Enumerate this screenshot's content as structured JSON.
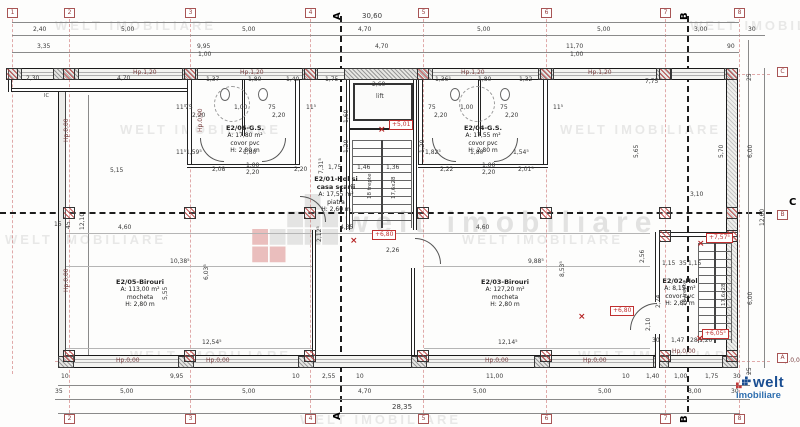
{
  "watermark": {
    "tile_text": "WELT IMOBILIARE",
    "center_text": "welt imobiliare"
  },
  "logo": {
    "brand": "welt",
    "sub": "imobiliare"
  },
  "rooms": {
    "e205": {
      "name": "E2/05-Birouri",
      "area": "A: 113,00 m²",
      "floor": "mocheta",
      "height": "H: 2,80 m"
    },
    "e203": {
      "name": "E2/03-Birouri",
      "area": "A: 127,20 m²",
      "floor": "mocheta",
      "height": "H: 2,80 m"
    },
    "e206": {
      "name": "E2/06-G.S.",
      "area": "A: 17,80 m²",
      "floor": "covor pvc",
      "height": "H: 2,80 m"
    },
    "e204": {
      "name": "E2/04-G.S.",
      "area": "A: 17,55 m²",
      "floor": "covor pvc",
      "height": "H: 2,80 m"
    },
    "e201": {
      "name": "E2/01-Hol si",
      "name2": "casa scarii",
      "area": "A: 17,55 m²",
      "floor": "piatra",
      "height": "H: 2,60 m"
    },
    "e202": {
      "name": "E2/02-Hol",
      "area": "A: 8,15 m²",
      "floor": "covor pvc",
      "height": "H: 2,80 m"
    }
  },
  "watermarks": [
    {
      "x": 55,
      "y": 18
    },
    {
      "x": 690,
      "y": 18
    },
    {
      "x": 120,
      "y": 122
    },
    {
      "x": 560,
      "y": 122
    },
    {
      "x": 5,
      "y": 232
    },
    {
      "x": 462,
      "y": 232
    },
    {
      "x": 130,
      "y": 348
    },
    {
      "x": 578,
      "y": 348
    },
    {
      "x": 300,
      "y": 412
    }
  ],
  "bubbles": [
    {
      "t": "1",
      "x": 7,
      "y": 8
    },
    {
      "t": "2",
      "x": 64,
      "y": 8
    },
    {
      "t": "3",
      "x": 185,
      "y": 8
    },
    {
      "t": "4",
      "x": 305,
      "y": 8
    },
    {
      "t": "5",
      "x": 418,
      "y": 8
    },
    {
      "t": "6",
      "x": 541,
      "y": 8
    },
    {
      "t": "7",
      "x": 660,
      "y": 8
    },
    {
      "t": "8",
      "x": 734,
      "y": 8
    },
    {
      "t": "2",
      "x": 64,
      "y": 414
    },
    {
      "t": "3",
      "x": 185,
      "y": 414
    },
    {
      "t": "4",
      "x": 305,
      "y": 414
    },
    {
      "t": "5",
      "x": 418,
      "y": 414
    },
    {
      "t": "6",
      "x": 541,
      "y": 414
    },
    {
      "t": "7",
      "x": 660,
      "y": 414
    },
    {
      "t": "8",
      "x": 734,
      "y": 414
    },
    {
      "t": "C",
      "x": 777,
      "y": 67
    },
    {
      "t": "B",
      "x": 777,
      "y": 210
    },
    {
      "t": "A",
      "x": 777,
      "y": 353
    }
  ],
  "sections": [
    {
      "t": "A",
      "x": 333,
      "y": 20,
      "r": -90
    },
    {
      "t": "B",
      "x": 680,
      "y": 20,
      "r": -90
    },
    {
      "t": "A",
      "x": 333,
      "y": 420,
      "r": -90
    },
    {
      "t": "B",
      "x": 680,
      "y": 423,
      "r": -90
    },
    {
      "t": "C",
      "x": 789,
      "y": 198,
      "r": 0
    }
  ],
  "elevations": [
    {
      "t": "+5,01",
      "x": 389,
      "y": 120
    },
    {
      "t": "+6,80",
      "x": 372,
      "y": 230
    },
    {
      "t": "+6,80",
      "x": 610,
      "y": 306
    },
    {
      "t": "+7,57⁵",
      "x": 706,
      "y": 233
    },
    {
      "t": "+6,05⁵",
      "x": 702,
      "y": 329
    }
  ],
  "crosses": [
    {
      "t": "×",
      "x": 378,
      "y": 126
    },
    {
      "t": "×",
      "x": 350,
      "y": 237
    },
    {
      "t": "×",
      "x": 578,
      "y": 313
    },
    {
      "t": "×",
      "x": 697,
      "y": 240
    },
    {
      "t": "×",
      "x": 696,
      "y": 335
    }
  ],
  "hp_labels": [
    {
      "t": "Hp.1,20",
      "x": 133,
      "y": 70
    },
    {
      "t": "Hp.1,20",
      "x": 240,
      "y": 70
    },
    {
      "t": "Hp.1,20",
      "x": 461,
      "y": 70
    },
    {
      "t": "Hp.1,20",
      "x": 588,
      "y": 70
    },
    {
      "t": "Hp.0,00",
      "x": 116,
      "y": 358
    },
    {
      "t": "Hp.0,00",
      "x": 206,
      "y": 358
    },
    {
      "t": "Hp.0,00",
      "x": 485,
      "y": 358
    },
    {
      "t": "Hp.0,00",
      "x": 583,
      "y": 358
    },
    {
      "t": "Hp.0,00",
      "x": 672,
      "y": 349
    },
    {
      "t": "Hp.0,00",
      "x": 780,
      "y": 358
    },
    {
      "t": "Hp.0,00",
      "x": 64,
      "y": 142,
      "r": -90
    },
    {
      "t": "Hp.0,00",
      "x": 64,
      "y": 292,
      "r": -90
    },
    {
      "t": "Hp.0,00",
      "x": 198,
      "y": 132,
      "r": -90
    }
  ],
  "labels": [
    {
      "t": "30,60",
      "x": 362,
      "y": 13,
      "fs": 7
    },
    {
      "t": "2,40",
      "x": 33,
      "y": 27
    },
    {
      "t": "5,00",
      "x": 121,
      "y": 27
    },
    {
      "t": "5,00",
      "x": 242,
      "y": 27
    },
    {
      "t": "4,70",
      "x": 358,
      "y": 27
    },
    {
      "t": "5,00",
      "x": 477,
      "y": 27
    },
    {
      "t": "5,00",
      "x": 597,
      "y": 27
    },
    {
      "t": "3,00",
      "x": 694,
      "y": 27
    },
    {
      "t": "30",
      "x": 748,
      "y": 27
    },
    {
      "t": "3,35",
      "x": 37,
      "y": 44
    },
    {
      "t": "9,95",
      "x": 197,
      "y": 44
    },
    {
      "t": "1,00",
      "x": 198,
      "y": 52
    },
    {
      "t": "4,70",
      "x": 375,
      "y": 44
    },
    {
      "t": "11,70",
      "x": 566,
      "y": 44
    },
    {
      "t": "1,00",
      "x": 570,
      "y": 52
    },
    {
      "t": "90",
      "x": 727,
      "y": 44
    },
    {
      "t": "10",
      "x": 61,
      "y": 374
    },
    {
      "t": "9,95",
      "x": 170,
      "y": 374
    },
    {
      "t": "10",
      "x": 292,
      "y": 374
    },
    {
      "t": "2,55",
      "x": 322,
      "y": 374
    },
    {
      "t": "10",
      "x": 356,
      "y": 374
    },
    {
      "t": "11,00",
      "x": 486,
      "y": 374
    },
    {
      "t": "10",
      "x": 622,
      "y": 374
    },
    {
      "t": "1,40",
      "x": 646,
      "y": 374
    },
    {
      "t": "1,00",
      "x": 674,
      "y": 374
    },
    {
      "t": "1,75",
      "x": 705,
      "y": 374
    },
    {
      "t": "30",
      "x": 733,
      "y": 374
    },
    {
      "t": "35",
      "x": 55,
      "y": 389
    },
    {
      "t": "5,00",
      "x": 120,
      "y": 389
    },
    {
      "t": "5,00",
      "x": 242,
      "y": 389
    },
    {
      "t": "4,70",
      "x": 358,
      "y": 389
    },
    {
      "t": "5,00",
      "x": 473,
      "y": 389
    },
    {
      "t": "5,00",
      "x": 598,
      "y": 389
    },
    {
      "t": "3,00",
      "x": 688,
      "y": 389
    },
    {
      "t": "30",
      "x": 731,
      "y": 389
    },
    {
      "t": "28,35",
      "x": 392,
      "y": 404,
      "fs": 7
    },
    {
      "t": "25",
      "x": 747,
      "y": 81,
      "r": -90
    },
    {
      "t": "5,65",
      "x": 634,
      "y": 158,
      "r": -90
    },
    {
      "t": "5,70",
      "x": 719,
      "y": 158,
      "r": -90
    },
    {
      "t": "6,00",
      "x": 748,
      "y": 158,
      "r": -90
    },
    {
      "t": "12,60",
      "x": 760,
      "y": 226,
      "r": -90
    },
    {
      "t": "6,00",
      "x": 748,
      "y": 305,
      "r": -90
    },
    {
      "t": "2,56",
      "x": 640,
      "y": 263,
      "r": -90
    },
    {
      "t": "2,74",
      "x": 656,
      "y": 308,
      "r": -90
    },
    {
      "t": "2,10",
      "x": 646,
      "y": 331,
      "r": -90
    },
    {
      "t": "25",
      "x": 747,
      "y": 375,
      "r": -90
    },
    {
      "t": "3,10",
      "x": 690,
      "y": 192
    },
    {
      "t": "7,75",
      "x": 645,
      "y": 79
    },
    {
      "t": "12,10",
      "x": 80,
      "y": 230,
      "r": -90
    },
    {
      "t": "15",
      "x": 54,
      "y": 222
    },
    {
      "t": "45",
      "x": 66,
      "y": 229,
      "r": -90
    },
    {
      "t": "2,30",
      "x": 26,
      "y": 76
    },
    {
      "t": "4,70",
      "x": 117,
      "y": 76
    },
    {
      "t": "IC",
      "x": 44,
      "y": 94,
      "fs": 5
    },
    {
      "t": "1,37",
      "x": 206,
      "y": 77
    },
    {
      "t": "1,80",
      "x": 248,
      "y": 77
    },
    {
      "t": "1,40",
      "x": 286,
      "y": 77
    },
    {
      "t": "1,75",
      "x": 325,
      "y": 77
    },
    {
      "t": "2,60",
      "x": 372,
      "y": 82
    },
    {
      "t": "1,36⁵",
      "x": 435,
      "y": 77
    },
    {
      "t": "1,80",
      "x": 478,
      "y": 77
    },
    {
      "t": "1,32",
      "x": 519,
      "y": 77
    },
    {
      "t": "11⁵",
      "x": 176,
      "y": 105
    },
    {
      "t": "11⁵",
      "x": 306,
      "y": 105
    },
    {
      "t": "11⁵",
      "x": 553,
      "y": 105
    },
    {
      "t": "11⁵",
      "x": 176,
      "y": 150
    },
    {
      "t": "75",
      "x": 185,
      "y": 105
    },
    {
      "t": "1,00",
      "x": 234,
      "y": 105
    },
    {
      "t": "75",
      "x": 268,
      "y": 105
    },
    {
      "t": "2,20",
      "x": 192,
      "y": 113
    },
    {
      "t": "2,20",
      "x": 272,
      "y": 113
    },
    {
      "t": "75",
      "x": 428,
      "y": 105
    },
    {
      "t": "1,00",
      "x": 460,
      "y": 105
    },
    {
      "t": "75",
      "x": 500,
      "y": 105
    },
    {
      "t": "2,20",
      "x": 434,
      "y": 113
    },
    {
      "t": "2,20",
      "x": 505,
      "y": 113
    },
    {
      "t": "1,60",
      "x": 344,
      "y": 123,
      "r": -90
    },
    {
      "t": "1,20",
      "x": 344,
      "y": 153,
      "r": -90
    },
    {
      "t": "1,20",
      "x": 420,
      "y": 153,
      "r": -90
    },
    {
      "t": "1,59⁵",
      "x": 186,
      "y": 150
    },
    {
      "t": "1,80",
      "x": 243,
      "y": 150
    },
    {
      "t": "1,82⁵",
      "x": 425,
      "y": 150
    },
    {
      "t": "1,80",
      "x": 470,
      "y": 150
    },
    {
      "t": "1,54⁵",
      "x": 513,
      "y": 150
    },
    {
      "t": "2,08",
      "x": 212,
      "y": 167
    },
    {
      "t": "1,00",
      "x": 246,
      "y": 163
    },
    {
      "t": "2,20",
      "x": 246,
      "y": 170
    },
    {
      "t": "2,20",
      "x": 294,
      "y": 167
    },
    {
      "t": "2,22",
      "x": 440,
      "y": 167
    },
    {
      "t": "1,00",
      "x": 482,
      "y": 163
    },
    {
      "t": "2,20",
      "x": 482,
      "y": 170
    },
    {
      "t": "2,01⁵",
      "x": 518,
      "y": 167
    },
    {
      "t": "5,15",
      "x": 110,
      "y": 168
    },
    {
      "t": "7,31⁵",
      "x": 319,
      "y": 174,
      "r": -90
    },
    {
      "t": "1,75",
      "x": 328,
      "y": 165
    },
    {
      "t": "1,46",
      "x": 357,
      "y": 165
    },
    {
      "t": "1,36",
      "x": 386,
      "y": 165
    },
    {
      "t": "4,60",
      "x": 118,
      "y": 225
    },
    {
      "t": "2,12⁵",
      "x": 317,
      "y": 242,
      "r": -90
    },
    {
      "t": "4,35",
      "x": 340,
      "y": 225
    },
    {
      "t": "2,26",
      "x": 386,
      "y": 248
    },
    {
      "t": "4,60",
      "x": 476,
      "y": 225
    },
    {
      "t": "10,38⁵",
      "x": 170,
      "y": 259
    },
    {
      "t": "5,55",
      "x": 163,
      "y": 300,
      "r": -90
    },
    {
      "t": "6,03⁵",
      "x": 204,
      "y": 280,
      "r": -90
    },
    {
      "t": "12,54⁵",
      "x": 202,
      "y": 340
    },
    {
      "t": "9,88⁵",
      "x": 528,
      "y": 259
    },
    {
      "t": "8,53⁵",
      "x": 560,
      "y": 277,
      "r": -90
    },
    {
      "t": "12,14⁵",
      "x": 498,
      "y": 340
    },
    {
      "t": "1,15",
      "x": 662,
      "y": 261
    },
    {
      "t": "35",
      "x": 679,
      "y": 261
    },
    {
      "t": "1,15",
      "x": 688,
      "y": 261
    },
    {
      "t": "30",
      "x": 652,
      "y": 338
    },
    {
      "t": "1,47",
      "x": 671,
      "y": 338
    },
    {
      "t": "28",
      "x": 690,
      "y": 338
    },
    {
      "t": "1,20",
      "x": 699,
      "y": 338
    },
    {
      "t": "lift",
      "x": 376,
      "y": 94,
      "fs": 6
    },
    {
      "t": "18 trepte",
      "x": 368,
      "y": 199,
      "r": -90,
      "fs": 5.5
    },
    {
      "t": "17,6x28",
      "x": 392,
      "y": 199,
      "r": -90,
      "fs": 5.5
    },
    {
      "t": "18 trepte",
      "x": 683,
      "y": 306,
      "r": -90,
      "fs": 5.5
    },
    {
      "t": "17,6x28",
      "x": 722,
      "y": 306,
      "r": -90,
      "fs": 5.5
    }
  ]
}
